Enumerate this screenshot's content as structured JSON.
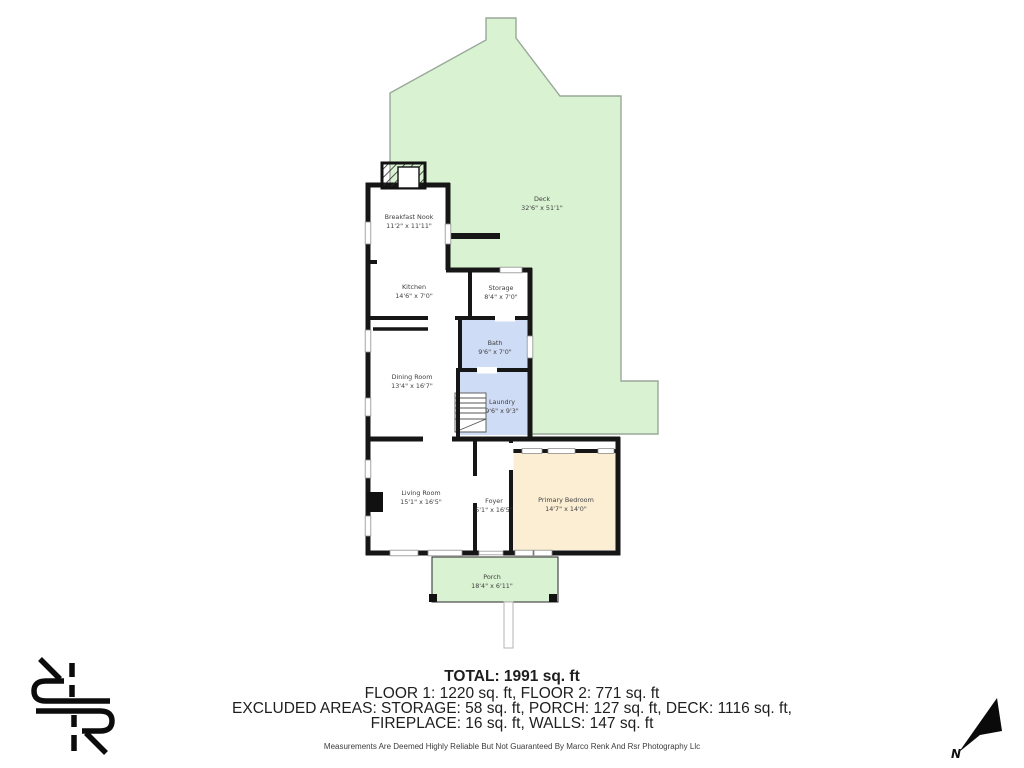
{
  "floorplan": {
    "rooms": {
      "deck": {
        "name": "Deck",
        "dims": "32'6\" x 51'1\""
      },
      "breakfast_nook": {
        "name": "Breakfast Nook",
        "dims": "11'2\" x 11'11\""
      },
      "kitchen": {
        "name": "Kitchen",
        "dims": "14'6\" x 7'0\""
      },
      "storage": {
        "name": "Storage",
        "dims": "8'4\" x 7'0\""
      },
      "bath": {
        "name": "Bath",
        "dims": "9'6\" x 7'0\""
      },
      "dining_room": {
        "name": "Dining Room",
        "dims": "13'4\" x 16'7\""
      },
      "laundry": {
        "name": "Laundry",
        "dims": "9'6\" x 9'3\""
      },
      "living_room": {
        "name": "Living Room",
        "dims": "15'1\" x 16'5\""
      },
      "foyer": {
        "name": "Foyer",
        "dims": "5'1\" x 16'5\""
      },
      "primary_bedroom": {
        "name": "Primary Bedroom",
        "dims": "14'7\" x 14'0\""
      },
      "porch": {
        "name": "Porch",
        "dims": "18'4\" x 6'11\""
      }
    },
    "colors": {
      "deck_green": "#d9f2d2",
      "wet_room_blue": "#cfdcf5",
      "bedroom_tan": "#fbeed3",
      "wall_black": "#161616"
    }
  },
  "summary": {
    "total": "TOTAL: 1991 sq. ft",
    "floors": "FLOOR 1: 1220 sq. ft, FLOOR 2: 771 sq. ft",
    "excluded1": "EXCLUDED AREAS: STORAGE: 58 sq. ft, PORCH: 127 sq. ft, DECK: 1116 sq. ft,",
    "excluded2": "FIREPLACE: 16 sq. ft, WALLS: 147 sq. ft",
    "disclaimer": "Measurements Are Deemed Highly Reliable But Not Guaranteed By Marco Renk And Rsr Photography Llc"
  },
  "compass": {
    "label": "N"
  }
}
